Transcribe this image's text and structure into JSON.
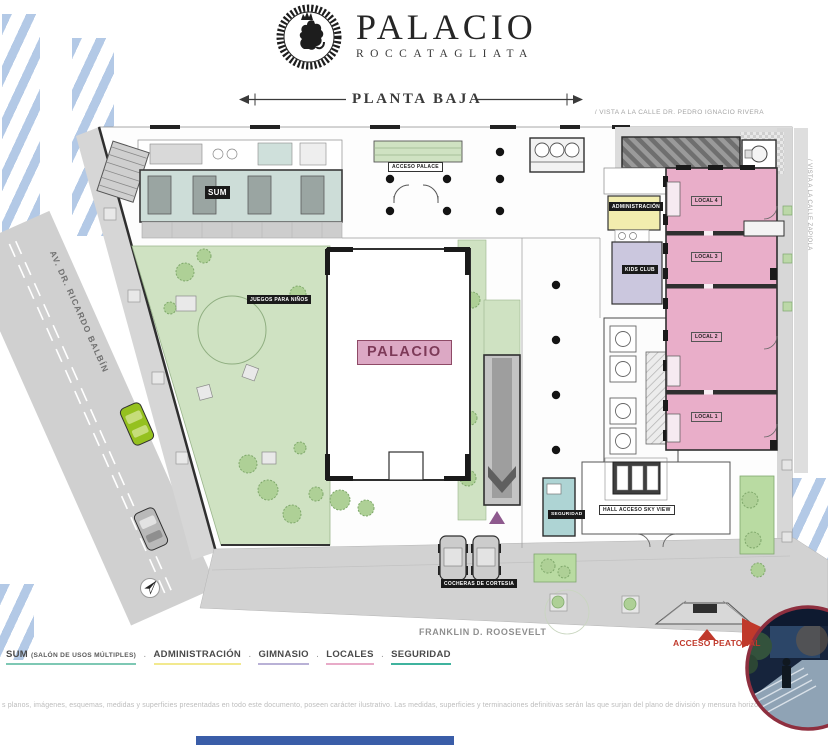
{
  "header": {
    "brand": "PALACIO",
    "brand_sub": "ROCCATAGLIATA",
    "plan_title": "PLANTA BAJA"
  },
  "streets": {
    "top": "/ VISTA A LA CALLE DR. PEDRO IGNACIO RIVERA",
    "right": "/ VISTA A LA CALLE ZAPIOLA",
    "left": "AV. DR. RICARDO BALBÍN",
    "bottom": "FRANKLIN D. ROOSEVELT"
  },
  "plan": {
    "labels": {
      "sum": "SUM",
      "acceso_palace": "ACCESO PALACE",
      "administracion": "ADMINISTRACIÓN",
      "kids_club": "KIDS CLUB",
      "palacio": "PALACIO",
      "juegos_para_ninos": "JUEGOS PARA NIÑOS",
      "seguridad": "SEGURIDAD",
      "hall_acceso": "HALL ACCESO SKY VIEW",
      "cocheras": "COCHERAS DE CORTESIA",
      "local_1": "LOCAL 1",
      "local_2": "LOCAL 2",
      "local_3": "LOCAL 3",
      "local_4": "LOCAL 4",
      "acceso_peatonal": "ACCESO PEATONAL"
    }
  },
  "legend": {
    "separator": "·",
    "items": [
      {
        "label": "SUM",
        "suffix": "(SALÓN DE USOS MÚLTIPLES)",
        "color": "#7ec8b4"
      },
      {
        "label": "ADMINISTRACIÓN",
        "suffix": "",
        "color": "#f2e98f"
      },
      {
        "label": "GIMNASIO",
        "suffix": "",
        "color": "#b9b1d6"
      },
      {
        "label": "LOCALES",
        "suffix": "",
        "color": "#e8abc8"
      },
      {
        "label": "SEGURIDAD",
        "suffix": "",
        "color": "#3fb39e"
      }
    ]
  },
  "disclaimer": "s planos, imágenes, esquemas, medidas y superficies presentadas en todo este documento, poseen carácter ilustrativo.   Las medidas, superficies y terminaciones definitivas serán las que surjan del plano de división y mensura horizontal",
  "colors": {
    "locales_pink": "#e9aec9",
    "garden_green": "#cfe2c2",
    "sum_teal": "#cdddd8",
    "admin_yellow": "#f2edae",
    "kids_lavender": "#cbc7de",
    "seguridad_teal": "#aed4d4",
    "sidewalk_gray": "#d2d2d2",
    "stripe_blue": "#b3c9e6",
    "accent_red": "#c0392b",
    "footer_blue": "#3a5da8"
  }
}
